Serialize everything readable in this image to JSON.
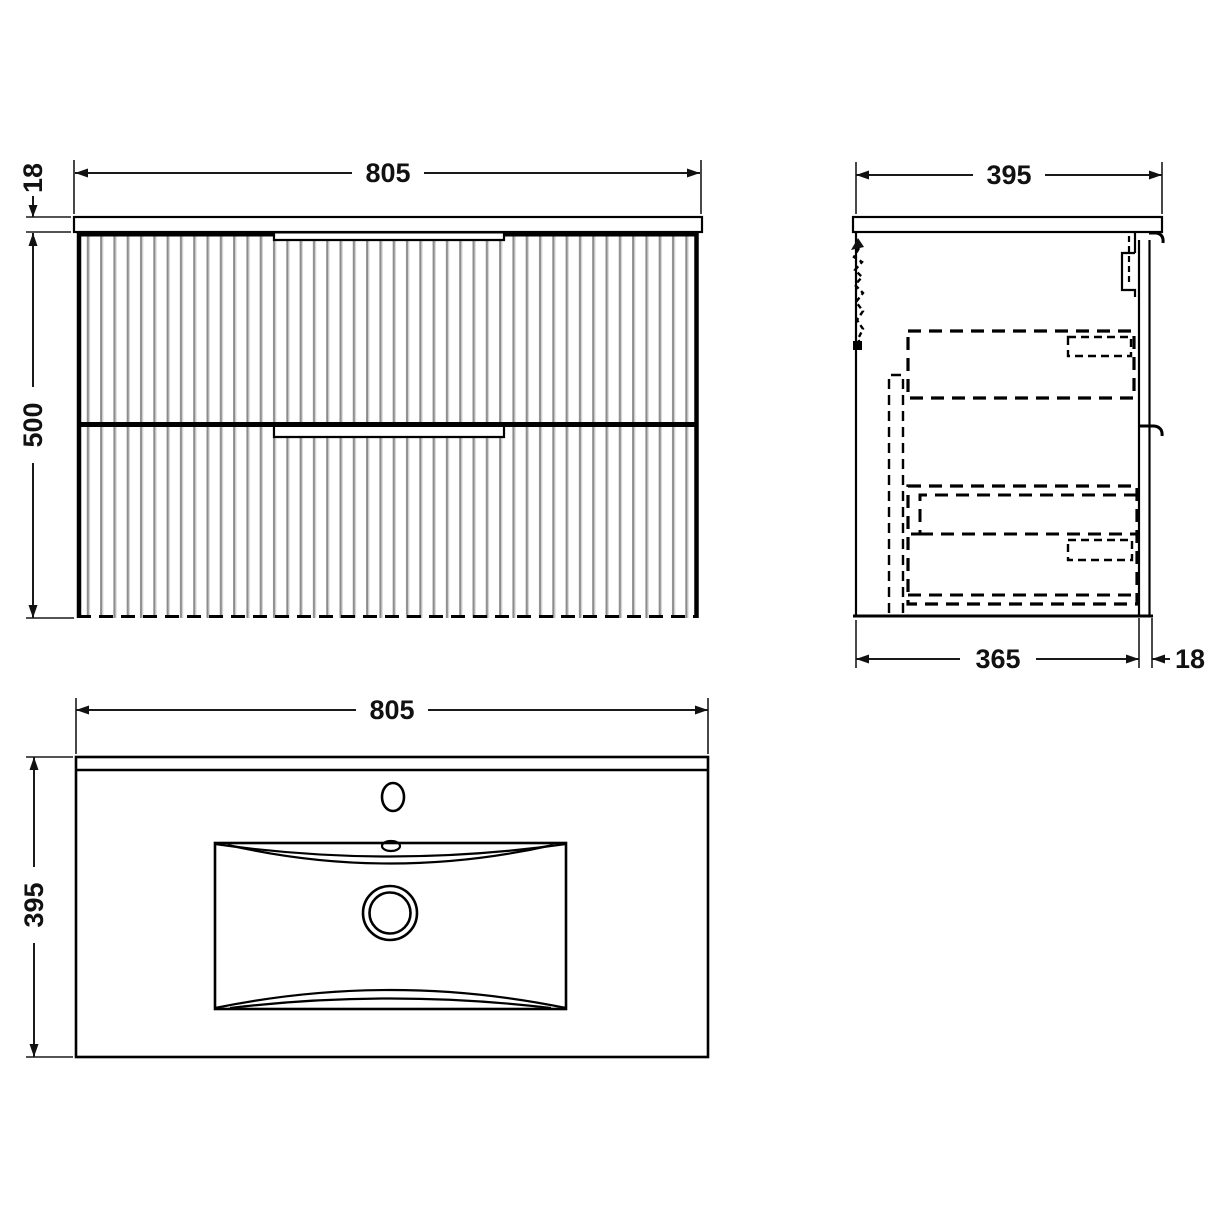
{
  "theme": {
    "background": "#ffffff",
    "line_color": "#000000",
    "dim_text_color": "#111111",
    "flute_dark": "#8c8c8c",
    "flute_light": "#d9d9d9"
  },
  "drawing": {
    "front_view": {
      "dims": {
        "width_mm": "805",
        "worktop_thickness_mm": "18",
        "cabinet_height_mm": "500"
      }
    },
    "side_view": {
      "dims": {
        "overall_depth_mm": "395",
        "carcass_depth_mm": "365",
        "front_thickness_mm": "18"
      }
    },
    "plan_view": {
      "dims": {
        "width_mm": "805",
        "depth_mm": "395"
      }
    }
  }
}
